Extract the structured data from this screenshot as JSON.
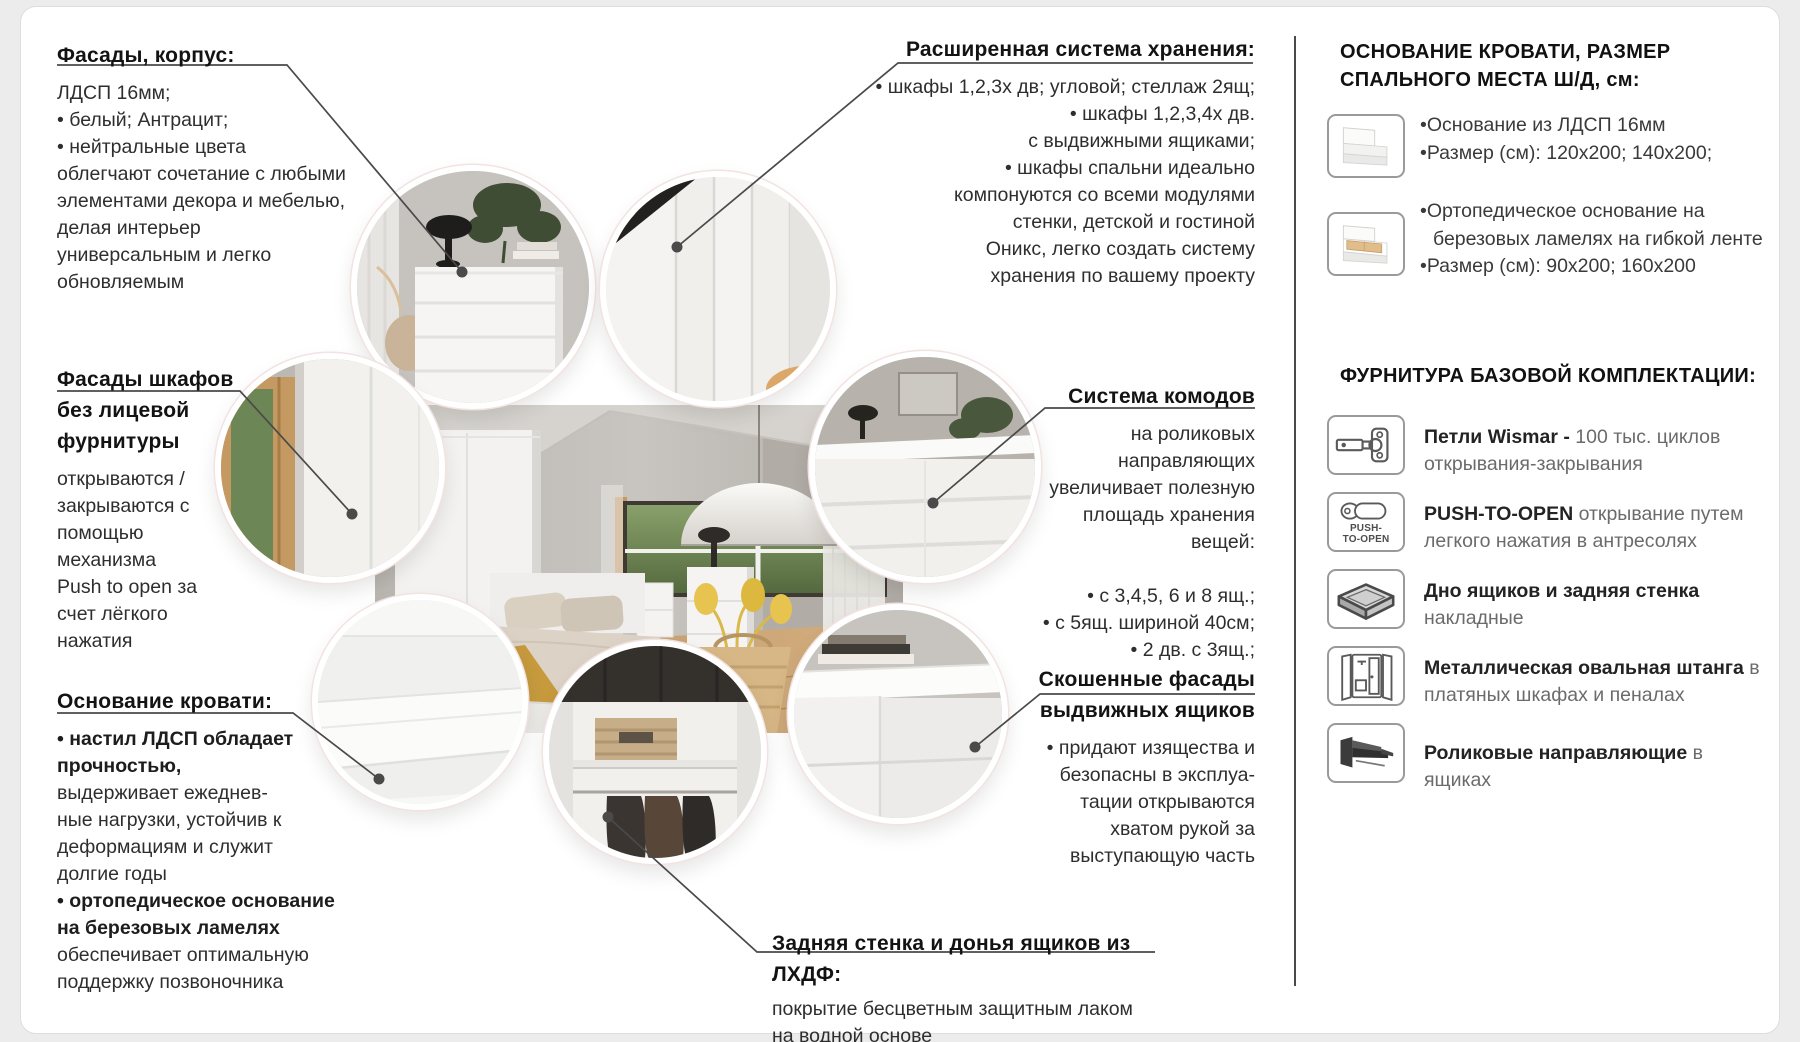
{
  "palette": {
    "text": "#1c1c1c",
    "muted": "#6b6b6b",
    "leader_line": "#4a4a4a",
    "divider": "#4a4a4a",
    "accent_throw": "#c79a3e",
    "rug": "#4d5c70"
  },
  "left_column": {
    "facades": {
      "heading": "Фасады, корпус:",
      "body": "ЛДСП 16мм;\n• белый; Антрацит;\n• нейтральные цвета\nоблегчают сочетание с любыми\nэлементами декора и мебелью,\nделая интерьер\nуниверсальным и легко\nобновляемым"
    },
    "fronts_no_hardware": {
      "heading": "Фасады шкафов\nбез лицевой\nфурнитуры",
      "body": "открываются /\nзакрываются с\nпомощью\nмеханизма\nPush to open за\nсчет лёгкого\nнажатия"
    },
    "bed_base": {
      "heading": "Основание кровати:",
      "seg1": "• настил ЛДСП обладает\nпрочностью,",
      "seg2": "выдерживает ежеднев-\nные нагрузки, устойчив к\nдеформациям и служит\nдолгие годы",
      "seg3": "• ортопедическое основание\nна березовых ламелях",
      "seg4": "обеспечивает оптимальную\nподдержку позвоночника"
    }
  },
  "center_column": {
    "storage": {
      "heading": "Расширенная система хранения:",
      "body": "• шкафы 1,2,3х дв; угловой; стеллаж 2ящ;\n• шкафы 1,2,3,4х дв.\nс выдвижными ящиками;\n• шкафы спальни идеально\nкомпонуются со всеми модулями\nстенки, детской и гостиной\nОникс, легко создать систему\nхранения по вашему проекту"
    },
    "dressers": {
      "heading": "Система комодов",
      "body": "на роликовых\nнаправляющих\nувеличивает полезную\nплощадь хранения\nвещей:\n\n• с 3,4,5, 6 и 8 ящ.;\n• с 5ящ. шириной 40см;\n• 2 дв. с 3ящ.;"
    },
    "beveled_fronts": {
      "heading": "Скошенные фасады\nвыдвижных ящиков",
      "body": "• придают изящества и\nбезопасны в эксплуа-\nтации открываются\nхватом рукой за\nвыступающую часть"
    },
    "back_wall": {
      "heading": "Задняя стенка и донья ящиков из ЛХДФ:",
      "body": "покрытие бесцветным защитным лаком\nна водной основе"
    }
  },
  "right_column": {
    "bed_section": {
      "title": "ОСНОВАНИЕ КРОВАТИ, РАЗМЕР\nСПАЛЬНОГО МЕСТА Ш/Д, см:",
      "rows": [
        {
          "icon": "bed-flat-icon",
          "bullets": [
            "•Основание из ЛДСП 16мм",
            "•Размер (см): 120х200; 140х200;"
          ]
        },
        {
          "icon": "bed-slats-icon",
          "bullets": [
            "•Ортопедическое основание на березовых ламелях на гибкой ленте",
            "•Размер (см): 90х200; 160х200"
          ]
        }
      ]
    },
    "hardware_section": {
      "title": "ФУРНИТУРА БАЗОВОЙ КОМПЛЕКТАЦИИ:",
      "items": [
        {
          "icon": "hinge-icon",
          "strong": "Петли Wismar -",
          "rest": " 100 тыс. циклов открывания-закрывания"
        },
        {
          "icon": "push-to-open-icon",
          "icon_label": "PUSH-\nTO-OPEN",
          "strong": "PUSH-TO-OPEN",
          "rest": " открывание путем легкого нажатия в антресолях"
        },
        {
          "icon": "drawer-bottom-icon",
          "strong": "Дно ящиков и задняя стенка",
          "rest": " накладные"
        },
        {
          "icon": "wardrobe-icon",
          "strong": "Металлическая овальная штанга",
          "rest": " в платяных шкафах и пеналах"
        },
        {
          "icon": "roller-slides-icon",
          "strong": "Роликовые направляющие",
          "rest": " в ящиках"
        }
      ]
    }
  }
}
